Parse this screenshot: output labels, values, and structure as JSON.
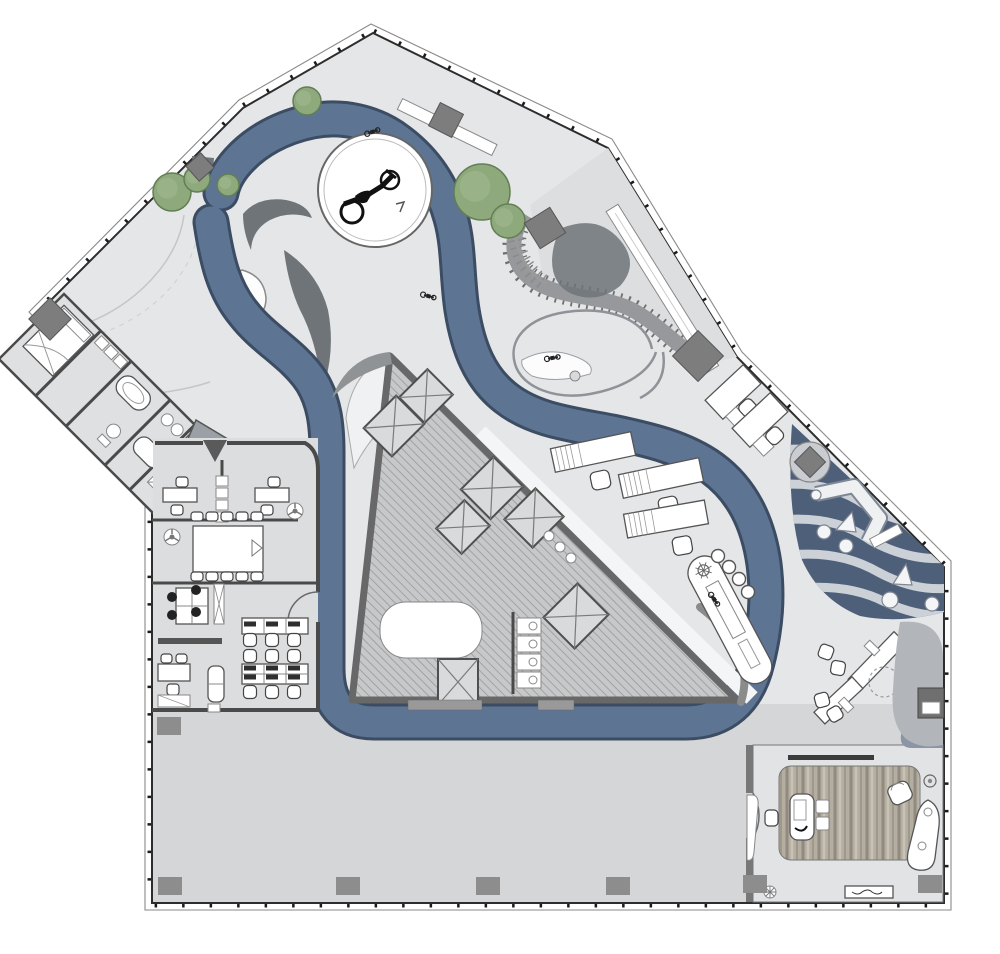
{
  "plan": {
    "kind": "architectural-floor-plan",
    "features": [
      "circulation-ribbon",
      "motorcycle-display-platform",
      "elevator-core",
      "open-office",
      "meeting-room",
      "suite-with-bath",
      "wave-garden",
      "executive-office",
      "landscape-terrace"
    ]
  },
  "colors": {
    "floor": "#e5e6e8",
    "hall": "#d5d6d8",
    "wall": "#2d2d2d",
    "ribbon": "#5d7492",
    "ribbonEdge": "#3b4c63",
    "coreFill": "#c7c8c9",
    "coreHatch": "#a2a2a2",
    "tree": "#8ea97c",
    "tree2": "#9cb489",
    "treeEdge": "#627e55",
    "garden": "#4e5f7a",
    "gardenStripe": "#ccd1d8",
    "darkShape": "#6f7478",
    "column": "#7d7d7d",
    "wood1": "#b3ada2",
    "wood2": "#928a7d"
  },
  "trees": [
    {
      "x": 172,
      "y": 192,
      "r": 19
    },
    {
      "x": 197,
      "y": 179,
      "r": 13
    },
    {
      "x": 228,
      "y": 185,
      "r": 11
    },
    {
      "x": 307,
      "y": 101,
      "r": 14
    },
    {
      "x": 482,
      "y": 192,
      "r": 28
    },
    {
      "x": 508,
      "y": 221,
      "r": 17
    }
  ],
  "elevators": [
    {
      "x": 394,
      "y": 426,
      "w": 46,
      "h": 40,
      "r": -45
    },
    {
      "x": 426,
      "y": 396,
      "w": 40,
      "h": 36,
      "r": -45
    },
    {
      "x": 492,
      "y": 488,
      "w": 46,
      "h": 42,
      "r": -45
    },
    {
      "x": 463,
      "y": 527,
      "w": 40,
      "h": 36,
      "r": -45
    },
    {
      "x": 534,
      "y": 518,
      "w": 44,
      "h": 40,
      "r": -45
    },
    {
      "x": 576,
      "y": 616,
      "w": 48,
      "h": 44,
      "r": -45
    },
    {
      "x": 458,
      "y": 682,
      "w": 40,
      "h": 46,
      "r": 0
    }
  ],
  "wall_columns": [
    {
      "x": 50,
      "y": 319,
      "s": 30,
      "r": 45
    },
    {
      "x": 200,
      "y": 167,
      "s": 20,
      "r": -42
    },
    {
      "x": 446,
      "y": 120,
      "s": 26,
      "r": 27
    },
    {
      "x": 545,
      "y": 228,
      "s": 30,
      "r": 58
    },
    {
      "x": 698,
      "y": 356,
      "s": 36,
      "r": 45
    },
    {
      "x": 810,
      "y": 462,
      "s": 22,
      "r": 45
    }
  ],
  "hall_columns": [
    {
      "x": 169,
      "y": 726
    },
    {
      "x": 170,
      "y": 886
    },
    {
      "x": 348,
      "y": 886
    },
    {
      "x": 488,
      "y": 886
    },
    {
      "x": 618,
      "y": 886
    },
    {
      "x": 755,
      "y": 884
    },
    {
      "x": 930,
      "y": 884
    }
  ],
  "counter_stools": [
    {
      "x": 718,
      "y": 556
    },
    {
      "x": 729,
      "y": 567
    },
    {
      "x": 739,
      "y": 579
    },
    {
      "x": 748,
      "y": 592
    }
  ],
  "garden_stones": [
    {
      "x": 816,
      "y": 495,
      "r": 5
    },
    {
      "x": 824,
      "y": 532,
      "r": 7
    },
    {
      "x": 846,
      "y": 546,
      "r": 7
    },
    {
      "x": 890,
      "y": 600,
      "r": 8
    },
    {
      "x": 932,
      "y": 604,
      "r": 7
    }
  ],
  "vehicle_icons": [
    {
      "x": 372,
      "y": 132,
      "r": -20
    },
    {
      "x": 428,
      "y": 296,
      "r": 15
    },
    {
      "x": 552,
      "y": 358,
      "r": -10
    },
    {
      "x": 714,
      "y": 599,
      "r": 55
    }
  ],
  "meeting_chairs": [
    {
      "x": 197,
      "y": 516
    },
    {
      "x": 212,
      "y": 516
    },
    {
      "x": 227,
      "y": 516
    },
    {
      "x": 242,
      "y": 516
    },
    {
      "x": 257,
      "y": 516
    },
    {
      "x": 197,
      "y": 576
    },
    {
      "x": 212,
      "y": 576
    },
    {
      "x": 227,
      "y": 576
    },
    {
      "x": 242,
      "y": 576
    },
    {
      "x": 257,
      "y": 576
    }
  ],
  "open_office_chairs": [
    {
      "x": 250,
      "y": 640
    },
    {
      "x": 272,
      "y": 640
    },
    {
      "x": 294,
      "y": 640
    },
    {
      "x": 250,
      "y": 656
    },
    {
      "x": 272,
      "y": 656
    },
    {
      "x": 294,
      "y": 656
    },
    {
      "x": 250,
      "y": 692
    },
    {
      "x": 272,
      "y": 692
    },
    {
      "x": 294,
      "y": 692
    }
  ],
  "bench_monitors": [
    {
      "x": 250,
      "y": 624
    },
    {
      "x": 272,
      "y": 624
    },
    {
      "x": 294,
      "y": 624
    },
    {
      "x": 250,
      "y": 668
    },
    {
      "x": 272,
      "y": 668
    },
    {
      "x": 294,
      "y": 668
    },
    {
      "x": 250,
      "y": 677
    },
    {
      "x": 272,
      "y": 677
    },
    {
      "x": 294,
      "y": 677
    }
  ],
  "cluster_chairs": [
    {
      "x": 172,
      "y": 597
    },
    {
      "x": 172,
      "y": 615
    },
    {
      "x": 196,
      "y": 590
    },
    {
      "x": 196,
      "y": 612
    }
  ],
  "wc_stalls": [
    {
      "x": 517,
      "y": 618
    },
    {
      "x": 517,
      "y": 636
    },
    {
      "x": 517,
      "y": 654
    },
    {
      "x": 517,
      "y": 672
    }
  ]
}
